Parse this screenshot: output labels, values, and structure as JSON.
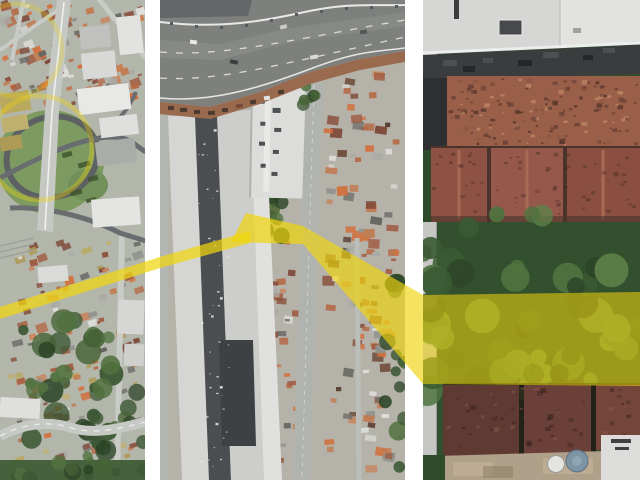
{
  "page": {
    "kind": "aerial-zoom-collage",
    "panel_count": 3,
    "description": "Three satellite views at increasing zoom connected by a yellow highlight marking a property lot"
  },
  "colors": {
    "accent_yellow": "#f0d50c",
    "gap_white": "#ffffff",
    "asphalt_light": "#c6c8c3",
    "asphalt_dark": "#7e807d",
    "grass": "#7d9b61",
    "dirt": "#9a6a4f",
    "warehouse_white": "#d5d6d3",
    "warehouse_dark": "#4b4e50",
    "close_roof_brown": "#9a5f49",
    "veg_dark": "#33502e",
    "tank_blue": "#7c94a4",
    "roof_warm": [
      "#b56a47",
      "#c17a4e",
      "#a05a40",
      "#8a4f3b",
      "#c8845c",
      "#7c4534",
      "#d2703c"
    ],
    "roof_cool": [
      "#d8d8d5",
      "#a9aaa6",
      "#8f918d",
      "#70706c",
      "#e4e4e1",
      "#5e5f5b"
    ],
    "roof_tan": [
      "#b9a95e",
      "#c0b070",
      "#ad9a55"
    ],
    "greens": [
      "#3c5834",
      "#527240",
      "#2c4527",
      "#476337"
    ],
    "greens_light": [
      "#4f7340",
      "#5d8148",
      "#3a5a33",
      "#2c4527"
    ],
    "mottle_close": [
      "#5f3a2f",
      "#6d4438",
      "#c08a66",
      "#8a5643",
      "#4a2e26"
    ],
    "mottle_dark": [
      "#4a2e26",
      "#3a241f"
    ],
    "mottle_maroon": [
      "#3a241f",
      "#8a5c4d",
      "#2c1c18"
    ],
    "speckle_white": [
      "#e8e9e6",
      "#d2d3d0",
      "#f2f3f0"
    ]
  },
  "panels": [
    {
      "name": "aerial-overview-city",
      "zoom_level": "far",
      "x": 0,
      "width": 145
    },
    {
      "name": "aerial-street-block",
      "zoom_level": "mid",
      "x": 160,
      "width": 245
    },
    {
      "name": "aerial-lot-closeup",
      "zoom_level": "near",
      "x": 423,
      "width": 217
    }
  ],
  "annotation": {
    "highlight_color": "#f0d50c",
    "shapes": [
      {
        "name": "route-line-overview",
        "points": [
          [
            0,
            307
          ],
          [
            160,
            257
          ],
          [
            250,
            231
          ],
          [
            250,
            243
          ],
          [
            160,
            268
          ],
          [
            0,
            319
          ]
        ],
        "opacity": 0.72
      },
      {
        "name": "parcel-highlight-mid",
        "points": [
          [
            246,
            213
          ],
          [
            303,
            226
          ],
          [
            303,
            244
          ],
          [
            231,
            242
          ]
        ],
        "opacity": 0.7
      },
      {
        "name": "zoom-wedge-connector",
        "points": [
          [
            303,
            226
          ],
          [
            423,
            295
          ],
          [
            423,
            384
          ],
          [
            303,
            244
          ]
        ],
        "opacity": 0.66
      },
      {
        "name": "parcel-band-closeup",
        "points": [
          [
            423,
            295
          ],
          [
            640,
            292
          ],
          [
            640,
            386
          ],
          [
            423,
            384
          ]
        ],
        "opacity": 0.56
      },
      {
        "name": "focus-circle-interchange",
        "type": "circle",
        "cx": 40,
        "cy": 148,
        "r": 52,
        "opacity": 0.35,
        "width": 5
      },
      {
        "name": "focus-circle-upper",
        "type": "circle",
        "cx": 16,
        "cy": 50,
        "r": 46,
        "opacity": 0.25,
        "width": 5
      }
    ]
  }
}
